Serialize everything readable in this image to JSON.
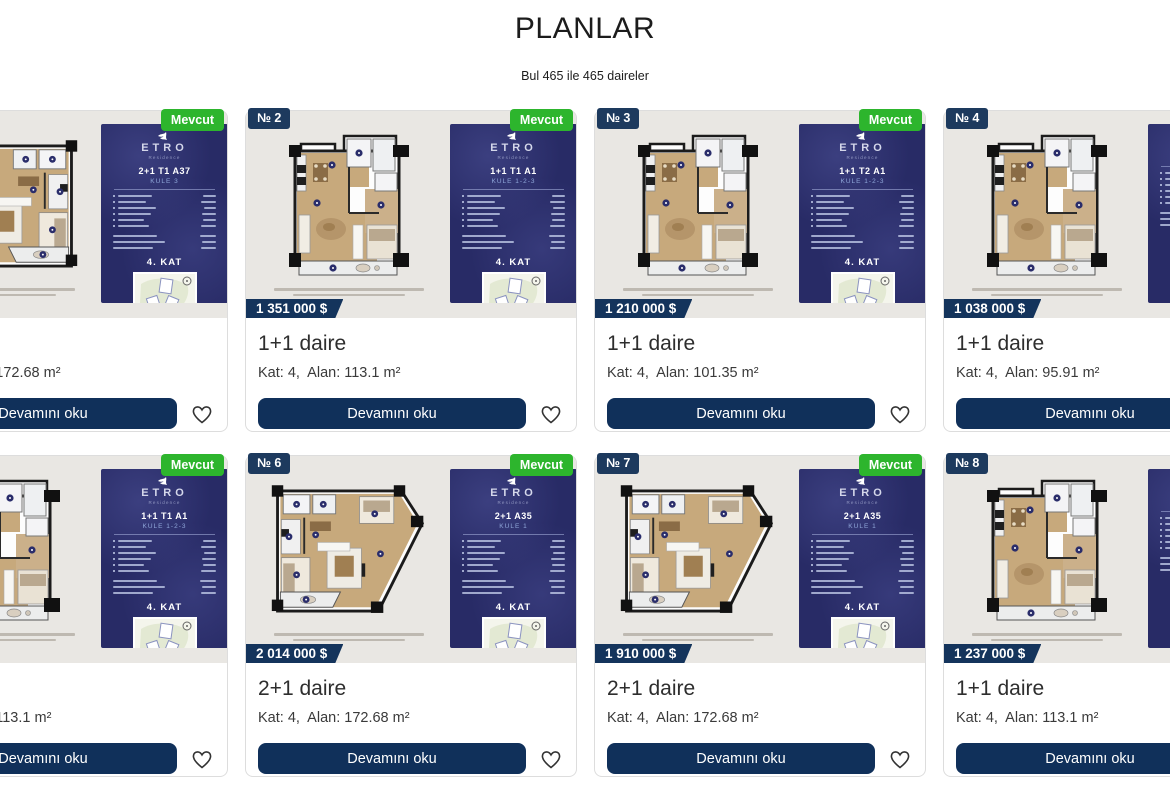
{
  "header": {
    "title": "PLANLAR",
    "subtitle": "Bul 465 ile 465 daireler"
  },
  "labels": {
    "read_more": "Devamını oku",
    "available_badge": "Mevcut",
    "brand": "ETRO",
    "brand_sub": "Residence",
    "heart_icon": "heart-outline"
  },
  "colors": {
    "navy_badge": "#1d3a5e",
    "navy_button": "#10305a",
    "navy_price": "#14345c",
    "available_green": "#2db52d",
    "panel_indigo": "#282b66",
    "image_background": "#e9e7e3"
  },
  "cards": [
    {
      "number": "№ 1",
      "available": "Mevcut",
      "price": "",
      "title": "2+1 daire",
      "meta": "Kat: 4,  Alan: 172.68 m²",
      "unit_code": "2+1 T1 A37",
      "tower": "KULE 3",
      "floor_banner": "4. KAT",
      "plan_shape": "trap",
      "plan_mirror": true
    },
    {
      "number": "№ 2",
      "available": "Mevcut",
      "price": "1 351 000 $",
      "title": "1+1 daire",
      "meta": "Kat: 4,  Alan: 113.1 m²",
      "unit_code": "1+1 T1 A1",
      "tower": "KULE 1-2-3",
      "floor_banner": "4. KAT",
      "plan_shape": "sq",
      "plan_mirror": false
    },
    {
      "number": "№ 3",
      "available": "Mevcut",
      "price": "1 210 000 $",
      "title": "1+1 daire",
      "meta": "Kat: 4,  Alan: 101.35 m²",
      "unit_code": "1+1 T2 A1",
      "tower": "KULE 1-2-3",
      "floor_banner": "4. KAT",
      "plan_shape": "sq",
      "plan_mirror": false
    },
    {
      "number": "№ 4",
      "available": "Mevcut",
      "price": "1 038 000 $",
      "title": "1+1 daire",
      "meta": "Kat: 4,  Alan: 95.91 m²",
      "unit_code": "",
      "tower": "",
      "floor_banner": "4. KAT",
      "plan_shape": "sq",
      "plan_mirror": false
    },
    {
      "number": "№ 5",
      "available": "Mevcut",
      "price": "",
      "title": "1+1 daire",
      "meta": "Kat: 4,  Alan: 113.1 m²",
      "unit_code": "1+1 T1 A1",
      "tower": "KULE 1-2-3",
      "floor_banner": "4. KAT",
      "plan_shape": "sq",
      "plan_mirror": false
    },
    {
      "number": "№ 6",
      "available": "Mevcut",
      "price": "2 014 000 $",
      "title": "2+1 daire",
      "meta": "Kat: 4,  Alan: 172.68 m²",
      "unit_code": "2+1 A35",
      "tower": "KULE 1",
      "floor_banner": "4. KAT",
      "plan_shape": "trap",
      "plan_mirror": false
    },
    {
      "number": "№ 7",
      "available": "Mevcut",
      "price": "1 910 000 $",
      "title": "2+1 daire",
      "meta": "Kat: 4,  Alan: 172.68 m²",
      "unit_code": "2+1 A35",
      "tower": "KULE 1",
      "floor_banner": "4. KAT",
      "plan_shape": "trap",
      "plan_mirror": false
    },
    {
      "number": "№ 8",
      "available": "Mevcut",
      "price": "1 237 000 $",
      "title": "1+1 daire",
      "meta": "Kat: 4,  Alan: 113.1 m²",
      "unit_code": "",
      "tower": "",
      "floor_banner": "4. KAT",
      "plan_shape": "sq",
      "plan_mirror": false
    }
  ]
}
